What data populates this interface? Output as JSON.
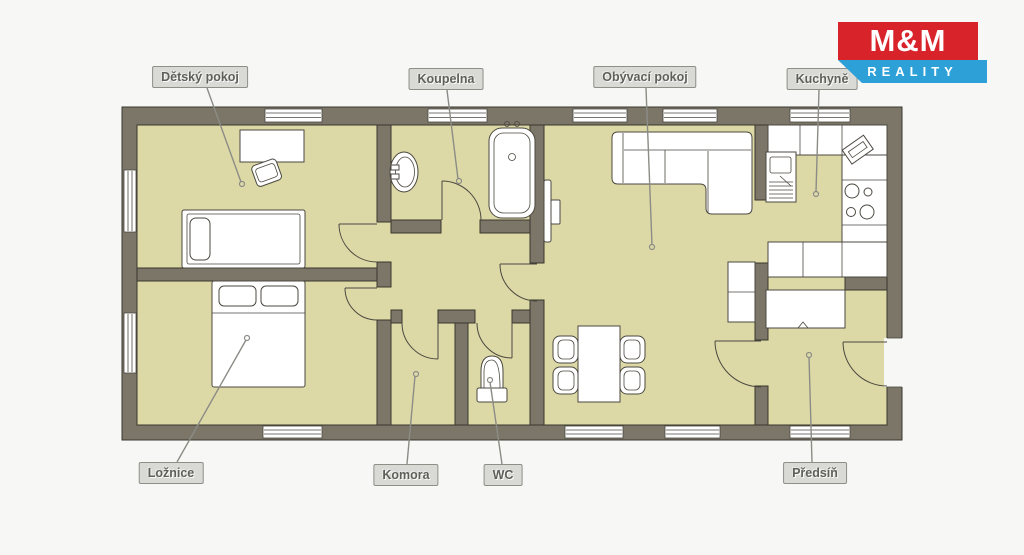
{
  "logo": {
    "line1": "M&M",
    "line2": "REALITY"
  },
  "rooms": [
    {
      "id": "detsky-pokoj",
      "label": "Dětský pokoj"
    },
    {
      "id": "koupelna",
      "label": "Koupelna"
    },
    {
      "id": "obyvaci-pokoj",
      "label": "Obývací pokoj"
    },
    {
      "id": "kuchyne",
      "label": "Kuchyně"
    },
    {
      "id": "loznice",
      "label": "Ložnice"
    },
    {
      "id": "komora",
      "label": "Komora"
    },
    {
      "id": "wc",
      "label": "WC"
    },
    {
      "id": "predsin",
      "label": "Předsíň"
    }
  ],
  "colors": {
    "wall": "#7b7668",
    "outline": "#3a372f",
    "floor": "#dcd9a6",
    "bg": "#f7f7f5",
    "furn_stroke": "#4b4840",
    "leader": "#8c8c86",
    "label_bg": "#d9d9d6",
    "label_border": "#8f8f88",
    "label_text": "#5f5f5a",
    "logo_red": "#d8232a",
    "logo_blue": "#2da0d8"
  }
}
